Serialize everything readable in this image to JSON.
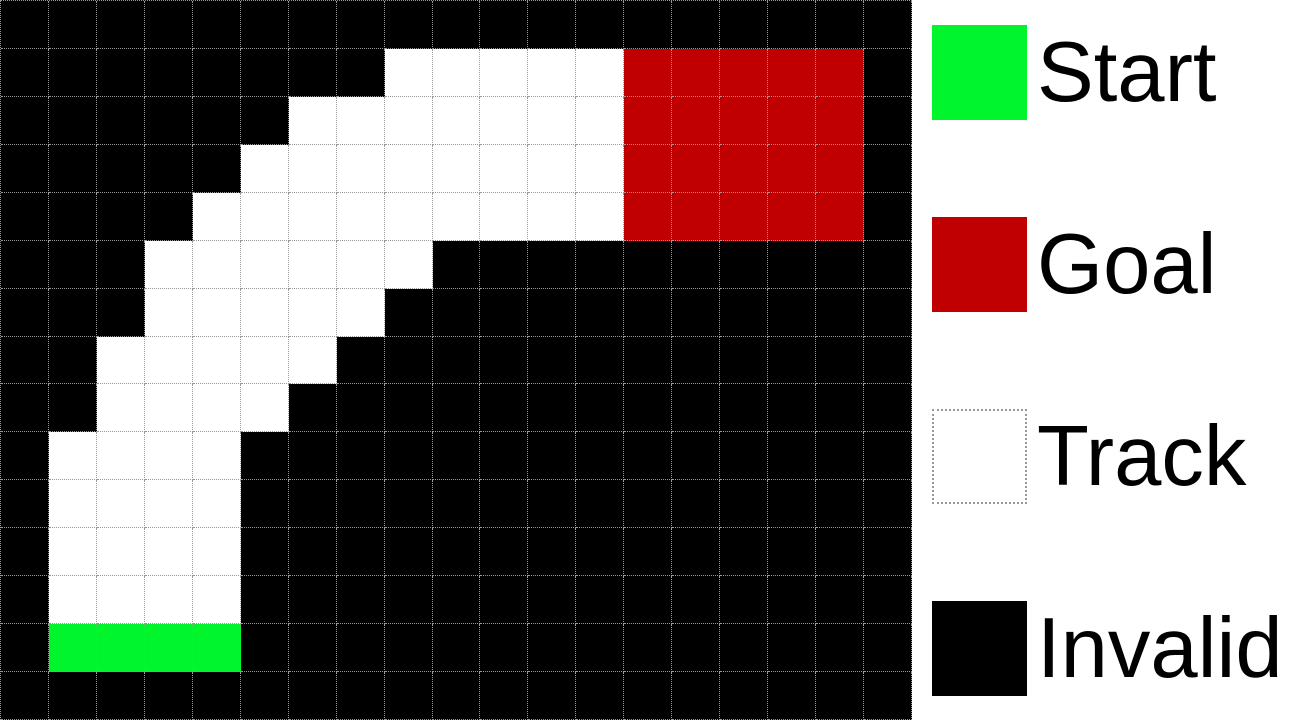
{
  "figure": {
    "description": "Racetrack gridworld map with legend",
    "background_color": "#ffffff"
  },
  "grid": {
    "rows": 15,
    "cols": 19,
    "cell_size_px": 48,
    "gridline_style": "dotted",
    "cell_types": {
      "K": "invalid",
      "W": "track",
      "G": "start",
      "R": "goal"
    },
    "colors": {
      "invalid": "#000000",
      "track": "#ffffff",
      "start": "#00f52d",
      "goal": "#c00000",
      "gridline": "#999999"
    },
    "map": [
      "KKKKKKKKKKKKKKKKKKK",
      "KKKKKKKKWWWWWRRRRRK",
      "KKKKKKWWWWWWWRRRRRK",
      "KKKKKWWWWWWWWRRRRRK",
      "KKKKWWWWWWWWWRRRRRK",
      "KKKWWWWWWKKKKKKKKKK",
      "KKKWWWWWKKKKKKKKKKK",
      "KKWWWWWKKKKKKKKKKKK",
      "KKWWWWKKKKKKKKKKKKK",
      "KWWWWKKKKKKKKKKKKKK",
      "KWWWWKKKKKKKKKKKKKK",
      "KWWWWKKKKKKKKKKKKKK",
      "KWWWWKKKKKKKKKKKKKK",
      "KGGGGKKKKKKKKKKKKKK",
      "KKKKKKKKKKKKKKKKKKK"
    ],
    "regions": {
      "start_cells": "row 13, columns 1-4",
      "goal_cells": "rows 1-4, columns 13-17"
    }
  },
  "legend": {
    "items": [
      {
        "label": "Start",
        "color": "#00f52d",
        "dotted_border": false
      },
      {
        "label": "Goal",
        "color": "#c00000",
        "dotted_border": false
      },
      {
        "label": "Track",
        "color": "#ffffff",
        "dotted_border": true
      },
      {
        "label": "Invalid",
        "color": "#000000",
        "dotted_border": false
      }
    ]
  }
}
